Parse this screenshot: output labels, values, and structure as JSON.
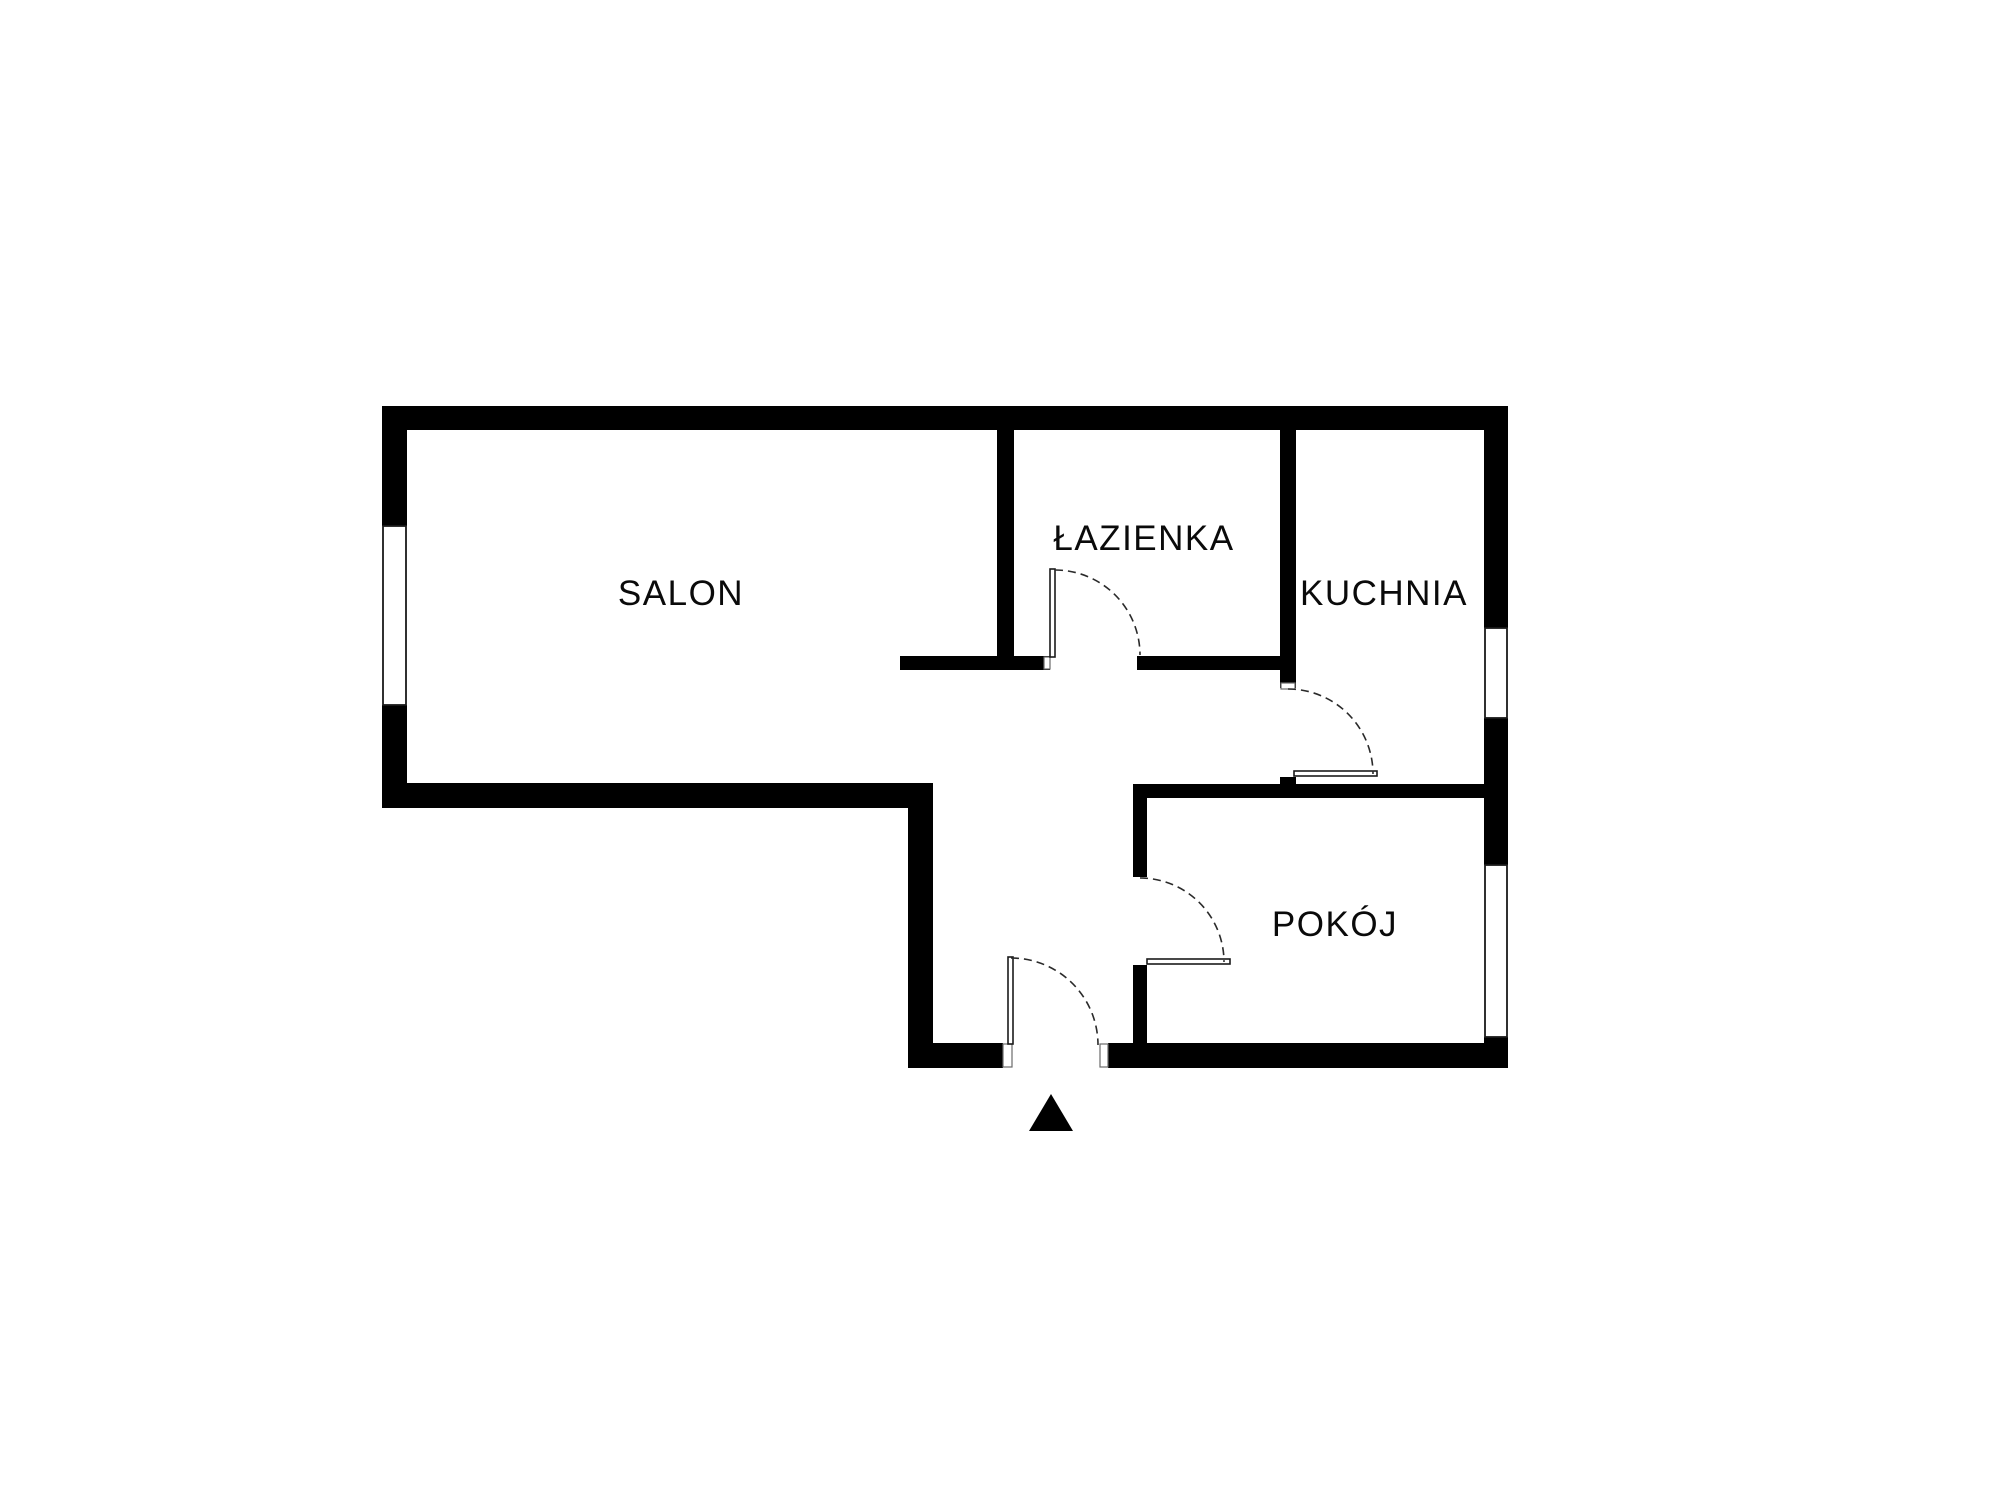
{
  "floorplan": {
    "canvas": {
      "width": 2000,
      "height": 1500,
      "background": "#ffffff",
      "wall_color": "#000000",
      "line_color": "#1a1a1a",
      "arc_color": "#2a2a2a",
      "jamb_color": "#6a6a6a"
    },
    "labels": {
      "font_size": 35,
      "letter_spacing": 1.5,
      "color": "#0a0a0a"
    },
    "rooms": [
      {
        "name": "room-salon",
        "label": "SALON",
        "cx": 681,
        "cy": 592
      },
      {
        "name": "room-lazienka",
        "label": "ŁAZIENKA",
        "cx": 1144,
        "cy": 537
      },
      {
        "name": "room-kuchnia",
        "label": "KUCHNIA",
        "cx": 1384,
        "cy": 592
      },
      {
        "name": "room-pokoj",
        "label": "POKÓJ",
        "cx": 1335,
        "cy": 923
      }
    ],
    "walls": [
      {
        "name": "top-exterior-wall",
        "x": 382,
        "y": 406,
        "w": 1126,
        "h": 24
      },
      {
        "name": "left-exterior-wall-upper",
        "x": 382,
        "y": 406,
        "w": 25,
        "h": 120
      },
      {
        "name": "left-exterior-wall-lower",
        "x": 382,
        "y": 705,
        "w": 25,
        "h": 103
      },
      {
        "name": "salon-bottom-exterior-wall",
        "x": 382,
        "y": 783,
        "w": 551,
        "h": 25
      },
      {
        "name": "hallway-left-exterior-wall",
        "x": 908,
        "y": 783,
        "w": 25,
        "h": 285
      },
      {
        "name": "bottom-exterior-wall-left",
        "x": 908,
        "y": 1043,
        "w": 95,
        "h": 25
      },
      {
        "name": "bottom-exterior-wall-right",
        "x": 1108,
        "y": 1043,
        "w": 400,
        "h": 25
      },
      {
        "name": "right-exterior-wall-upper",
        "x": 1484,
        "y": 406,
        "w": 24,
        "h": 222
      },
      {
        "name": "right-exterior-wall-middle",
        "x": 1484,
        "y": 718,
        "w": 24,
        "h": 147
      },
      {
        "name": "right-exterior-wall-lower",
        "x": 1484,
        "y": 1037,
        "w": 24,
        "h": 31
      },
      {
        "name": "salon-bathroom-wall",
        "x": 997,
        "y": 429,
        "w": 17,
        "h": 241
      },
      {
        "name": "salon-hallway-stub-wall",
        "x": 900,
        "y": 656,
        "w": 150,
        "h": 14
      },
      {
        "name": "bathroom-bottom-wall",
        "x": 1137,
        "y": 656,
        "w": 159,
        "h": 14
      },
      {
        "name": "bathroom-kitchen-wall",
        "x": 1280,
        "y": 429,
        "w": 16,
        "h": 259
      },
      {
        "name": "kitchen-door-stub-wall",
        "x": 1280,
        "y": 777,
        "w": 16,
        "h": 10
      },
      {
        "name": "pokoj-top-wall",
        "x": 1133,
        "y": 784,
        "w": 351,
        "h": 14
      },
      {
        "name": "pokoj-left-wall-upper",
        "x": 1133,
        "y": 798,
        "w": 14,
        "h": 79
      },
      {
        "name": "pokoj-left-wall-lower",
        "x": 1133,
        "y": 965,
        "w": 14,
        "h": 78
      }
    ],
    "windows": [
      {
        "name": "salon-window",
        "x": 383,
        "y": 526,
        "w": 23,
        "h": 179
      },
      {
        "name": "kuchnia-window",
        "x": 1485,
        "y": 628,
        "w": 22,
        "h": 90
      },
      {
        "name": "pokoj-window",
        "x": 1485,
        "y": 865,
        "w": 22,
        "h": 172
      }
    ],
    "door_jambs": [
      {
        "name": "entrance-left-jamb",
        "x": 1003,
        "y": 1044,
        "w": 9,
        "h": 23
      },
      {
        "name": "entrance-right-jamb",
        "x": 1100,
        "y": 1044,
        "w": 8,
        "h": 23
      },
      {
        "name": "kitchen-doorway-jamb",
        "x": 1281,
        "y": 683,
        "w": 14,
        "h": 6
      },
      {
        "name": "bathroom-doorway-jamb",
        "x": 1044,
        "y": 657,
        "w": 6,
        "h": 12
      }
    ],
    "door_leaves": [
      {
        "name": "bathroom-door-leaf",
        "x": 1050,
        "y": 569,
        "w": 5,
        "h": 88
      },
      {
        "name": "entrance-door-leaf",
        "x": 1008,
        "y": 957,
        "w": 5,
        "h": 87
      },
      {
        "name": "kitchen-door-leaf",
        "x": 1294,
        "y": 771,
        "w": 83,
        "h": 5
      },
      {
        "name": "pokoj-door-leaf",
        "x": 1147,
        "y": 959,
        "w": 83,
        "h": 5
      }
    ],
    "door_arcs": [
      {
        "name": "bathroom-door-arc",
        "x1": 1055,
        "y1": 570,
        "r": 85,
        "x2": 1140,
        "y2": 655
      },
      {
        "name": "kitchen-door-arc",
        "x1": 1288,
        "y1": 689,
        "r": 85,
        "x2": 1373,
        "y2": 774
      },
      {
        "name": "pokoj-door-arc",
        "x1": 1140,
        "y1": 878,
        "r": 84,
        "x2": 1224,
        "y2": 962
      },
      {
        "name": "entrance-door-arc",
        "x1": 1011,
        "y1": 958,
        "r": 87,
        "x2": 1098,
        "y2": 1045
      }
    ],
    "entrance_arrow": {
      "points": "1051,1094 1073,1131 1029,1131"
    }
  }
}
